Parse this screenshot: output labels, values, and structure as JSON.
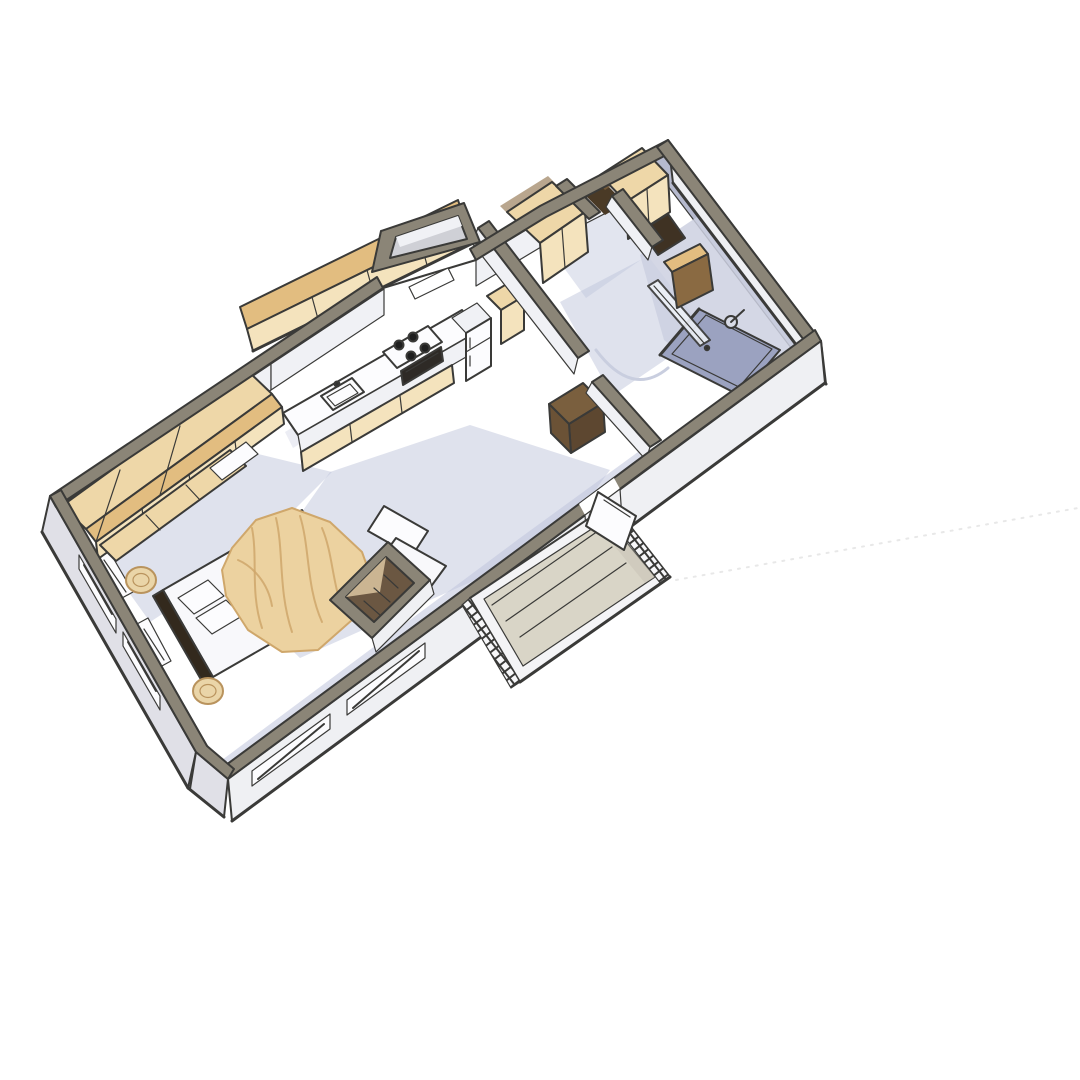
{
  "meta": {
    "view": "3d-axonometric-floor-plan",
    "description": "Top-down 3/4 rendering of a small one-room cabin apartment rotated diagonally on a white background"
  },
  "palette": {
    "bg": "#ffffff",
    "line": "#3a3a38",
    "wall-top": "#8b8577",
    "wall-face": "#eff0f3",
    "wall-face-shade": "#e0e0e7",
    "wall-inner": "#f0f1f5",
    "floor": "#ffffff",
    "shadow": "#bfc5dc",
    "shadow-deep": "#aab1cc",
    "wood-top": "#eed7a8",
    "wood-front": "#f4e3bd",
    "wood-side": "#e2bd80",
    "wood-dark": "#8a6a42",
    "wood-deep": "#4a3a26",
    "blanket": "#ecd2a0",
    "blanket-fold": "#cfa76b",
    "mattress": "#f8f8fb",
    "appliance": "#fcfcfe",
    "burner": "#1f1f1f",
    "bath-wall": "#b6bace",
    "bath-floor": "#ccd0e0",
    "shower-tray": "#9ba2c0",
    "deck-floor": "#d9d5c7",
    "fascia": "#f4f4f6",
    "stool": "#ead5a8",
    "stool-ring": "#b9935d",
    "arc": "#c9cedf",
    "ground-line": "#e8e8e8"
  },
  "scene": {
    "rooms": [
      {
        "name": "bedroom-living",
        "furniture": [
          "double-bed",
          "blanket",
          "pillows",
          "headboard",
          "round-stool",
          "round-stool",
          "lounge-chair",
          "wardrobe-run",
          "skylight-box"
        ]
      },
      {
        "name": "kitchen",
        "furniture": [
          "upper-cabinets",
          "counter",
          "sink",
          "cooktop",
          "oven",
          "refrigerator",
          "tall-cabinet"
        ]
      },
      {
        "name": "entry-vestibule",
        "furniture": []
      },
      {
        "name": "closet-room",
        "furniture": [
          "wardrobe",
          "wardrobe"
        ]
      },
      {
        "name": "hallway",
        "furniture": [
          "dresser",
          "door-swing-arc"
        ]
      },
      {
        "name": "bathroom",
        "furniture": [
          "shower-tray",
          "shower-head",
          "glass-screen",
          "wood-door-open"
        ]
      },
      {
        "name": "deck",
        "furniture": [
          "railing-hatched",
          "deck-door-open"
        ]
      }
    ],
    "windows": {
      "south-wall": 3,
      "west-wall": 2
    },
    "background": "plain-white"
  }
}
